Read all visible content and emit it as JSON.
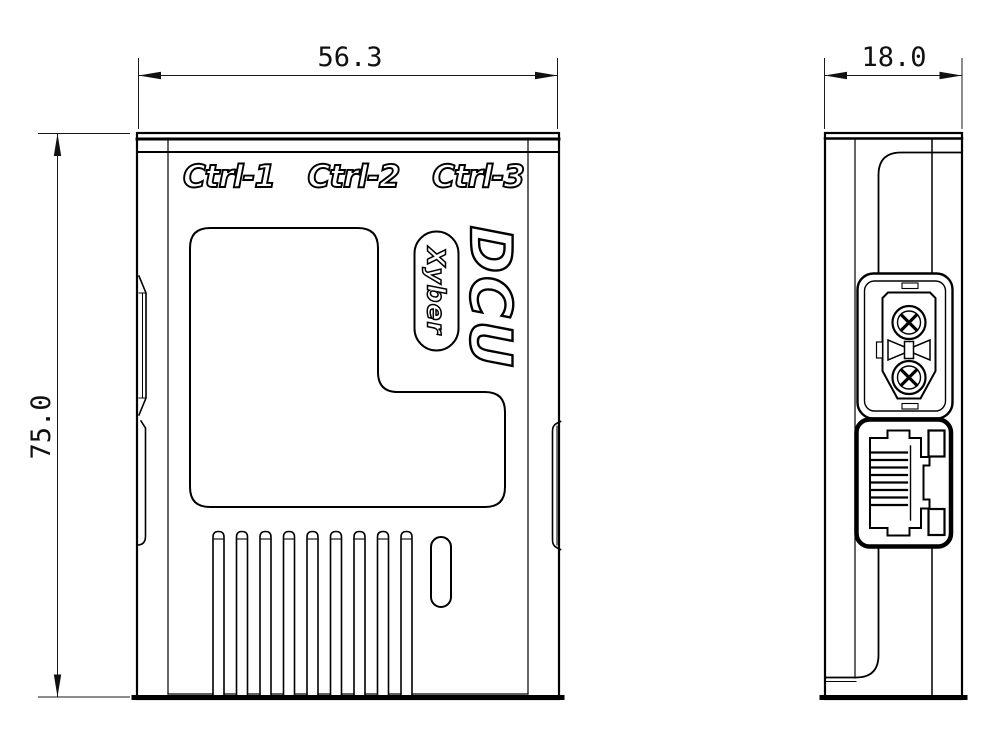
{
  "title": "DCU enclosure technical drawing",
  "front_view": {
    "port_labels": [
      "Ctrl-1",
      "Ctrl-2",
      "Ctrl-3"
    ],
    "logo_text": "DCU",
    "brand_text": "Xyber",
    "dim_width": "56.3",
    "dim_height": "75.0",
    "vent_slot_count": 9
  },
  "side_view": {
    "dim_depth": "18.0",
    "connectors": [
      "xt30-power-connector",
      "rj45-ethernet-jack"
    ]
  },
  "colors": {
    "line": "#000000",
    "dim_line": "#1a1a1a",
    "background": "#ffffff"
  }
}
